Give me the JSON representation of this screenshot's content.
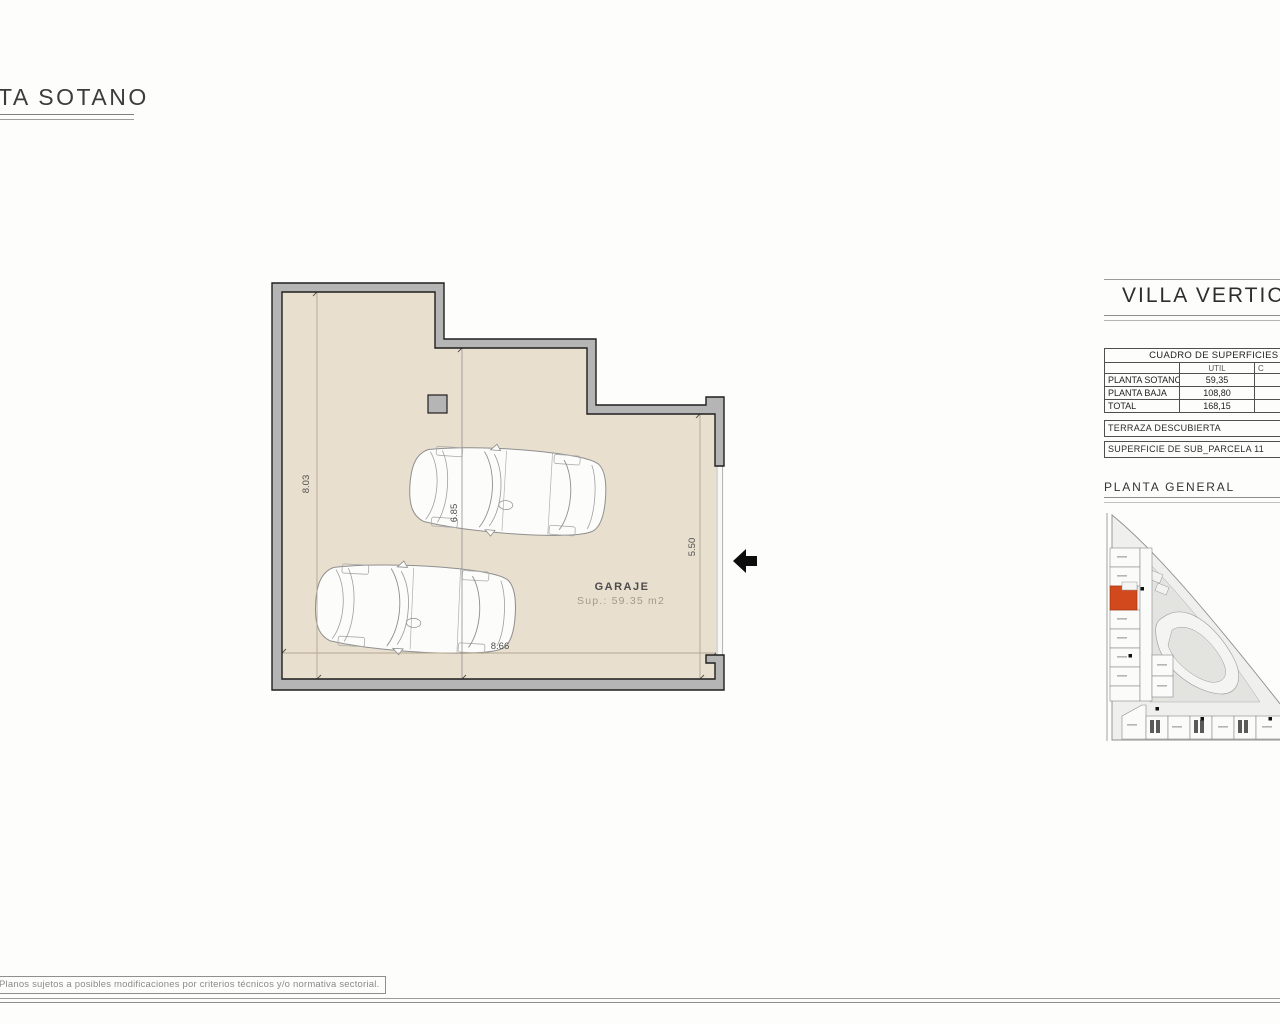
{
  "sheet": {
    "title": "TA SOTANO",
    "footer_note": "Planos sujetos a posibles modificaciones por criterios técnicos y/o normativa sectorial."
  },
  "plan": {
    "room": {
      "name": "GARAJE",
      "area": "Sup.: 59.35 m2"
    },
    "dims": {
      "height_left": "8.03",
      "height_mid": "6.85",
      "door_right": "5.50",
      "width_bottom": "8.66"
    }
  },
  "panel": {
    "title": "VILLA VERTICA",
    "table": {
      "title": "CUADRO DE SUPERFICIES (",
      "columns": {
        "util": "UTIL",
        "next_fragment": "C"
      },
      "rows": [
        {
          "label": "PLANTA SOTANO",
          "util": "59,35"
        },
        {
          "label": "PLANTA BAJA",
          "util": "108,80"
        },
        {
          "label": "TOTAL",
          "util": "168,15"
        }
      ]
    },
    "terraza": "TERRAZA DESCUBIERTA",
    "parcela": "SUPERFICIE DE SUB_PARCELA 11",
    "planta_general": "PLANTA GENERAL"
  },
  "colors": {
    "floor": "#e9dfcf",
    "wall": "#b5b5b5",
    "wall_outline": "#1f1f1f",
    "dimension_line": "#b3a692",
    "highlight_parcel": "#d2491d"
  }
}
